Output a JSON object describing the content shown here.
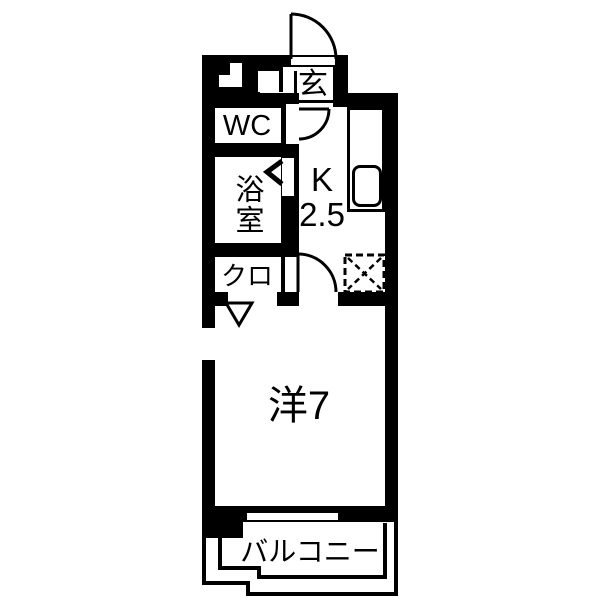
{
  "colors": {
    "wall": "#000000",
    "background": "#ffffff",
    "line": "#000000"
  },
  "floorplan": {
    "type": "apartment-floor-plan-1K",
    "labels": {
      "entrance": "玄",
      "toilet": "WC",
      "bathroom": "浴室",
      "kitchen_letter": "K",
      "kitchen_size": "2.5",
      "closet": "クロ",
      "main_room": "洋7",
      "balcony": "バルコニー"
    }
  }
}
